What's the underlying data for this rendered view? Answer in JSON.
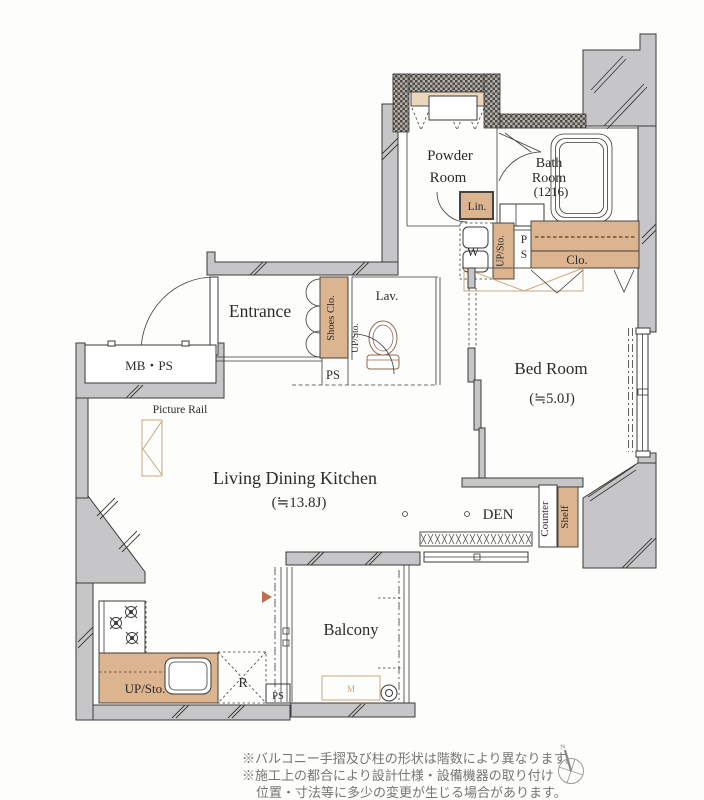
{
  "plan": {
    "rooms": {
      "powder": {
        "line1": "Powder",
        "line2": "Room"
      },
      "bath": {
        "line1": "Bath",
        "line2": "Room",
        "line3": "(1216)"
      },
      "entrance": "Entrance",
      "lav": "Lav.",
      "bed": {
        "name": "Bed Room",
        "size": "(≒5.0J)"
      },
      "ldk": {
        "name": "Living Dining Kitchen",
        "size": "(≒13.8J)"
      },
      "den": "DEN",
      "balcony": "Balcony"
    },
    "fixtures": {
      "lin": "Lin.",
      "washer": "W",
      "upsto_hall": "UP/Sto.",
      "pipe_p": "P",
      "pipe_s": "S",
      "closet": "Clo.",
      "shoes_closet": "Shoes Clo.",
      "ps_entrance": "PS",
      "mb_ps": "MB・PS",
      "picture_rail": "Picture Rail",
      "upsto_lav": "UP/Sto.",
      "counter": "Counter",
      "shelf": "Shelf",
      "upsto_kitchen": "UP/Sto.",
      "refrigerator": "R",
      "ps_kitchen": "PS",
      "meter": "M"
    },
    "compass": {
      "north": "N"
    },
    "notes": [
      "※バルコニー手摺及び柱の形状は階数により異なります。",
      "※施工上の都合により設計仕様・設備機器の取り付け",
      "位置・寸法等に多少の変更が生じる場合があります。"
    ],
    "colors": {
      "wall_gray": "#c6c6c8",
      "fixture_tan": "#dcb48f",
      "tan_outline": "#c9a87c",
      "line": "#3a3a3a",
      "marker_triangle": "#bf6f4f",
      "note_text": "#757575"
    }
  }
}
